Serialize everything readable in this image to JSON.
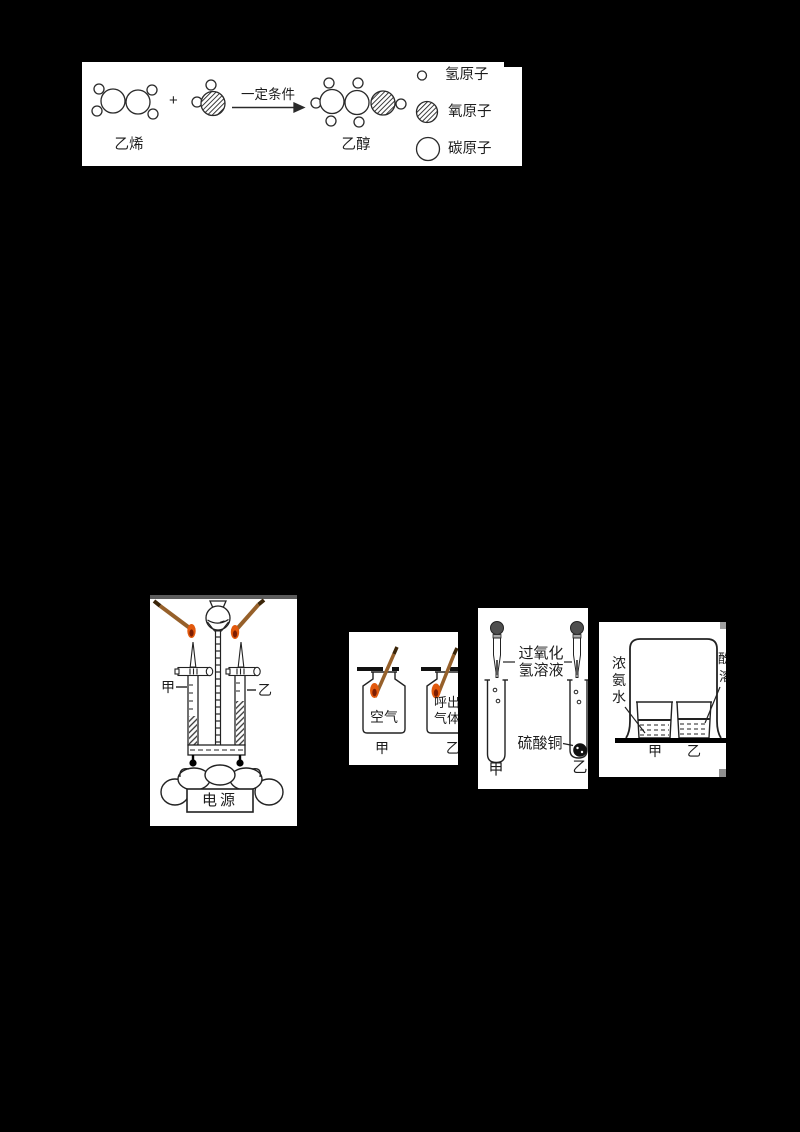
{
  "colors": {
    "background": "#000000",
    "panel": "#ffffff",
    "ink": "#222222",
    "splint_wood": "#96602a",
    "splint_char_tip": "#3b2508",
    "flame_outer": "#e2590d",
    "flame_core": "#7d1d02",
    "dropper_bulb": "#4f4f4f",
    "panel_top_strip": "#5c5c5c",
    "artifact_gray": "#a0a0a0"
  },
  "reaction_panel": {
    "reactant_label": "乙烯",
    "plus_sign": "+",
    "arrow_condition": "一定条件",
    "product_label": "乙醇",
    "legend": [
      {
        "symbol": "hydrogen-atom",
        "label": "氢原子"
      },
      {
        "symbol": "oxygen-atom",
        "label": "氧原子"
      },
      {
        "symbol": "carbon-atom",
        "label": "碳原子"
      }
    ]
  },
  "electrolysis_panel": {
    "left_tube_label": "甲",
    "right_tube_label": "乙",
    "power_supply_label": "电源"
  },
  "gas_bottles_panel": {
    "left_bottle_content": "空气",
    "left_caption": "甲",
    "right_bottle_content_line1": "呼出",
    "right_bottle_content_line2": "气体",
    "right_caption": "乙"
  },
  "peroxide_panel": {
    "reagent_label_line1": "过氧化",
    "reagent_label_line2": "氢溶液",
    "solid_label": "硫酸铜",
    "left_caption": "甲",
    "right_caption": "乙"
  },
  "ammonia_panel": {
    "left_reagent_chars": [
      "浓",
      "氨",
      "水"
    ],
    "right_reagent_clipped_chars": [
      "酚",
      "溶"
    ],
    "left_caption": "甲",
    "right_caption": "乙"
  }
}
